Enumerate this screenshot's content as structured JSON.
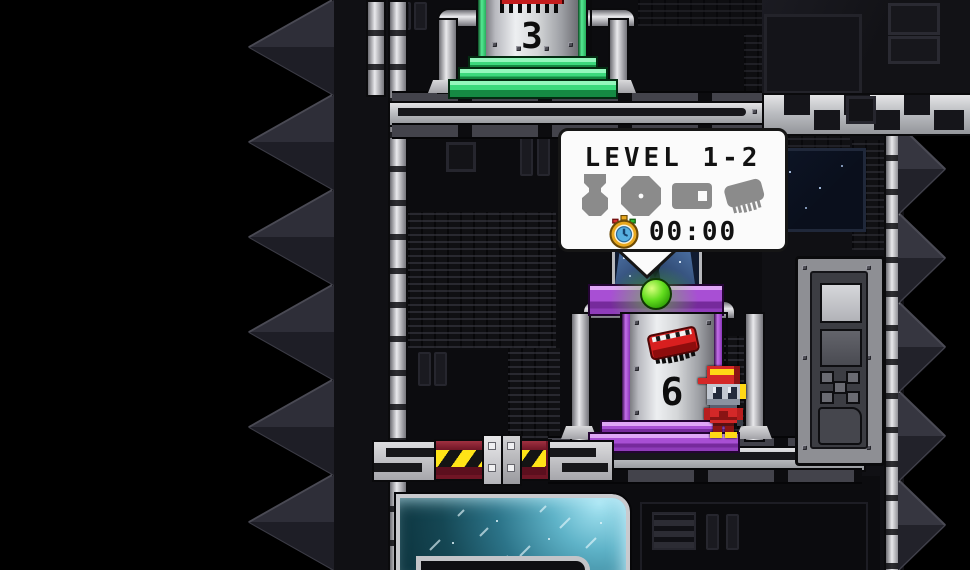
{
  "popup": {
    "title": "LEVEL 1-2",
    "collectible_icons": [
      {
        "name": "medal-silhouette"
      },
      {
        "name": "gear-silhouette"
      },
      {
        "name": "canister-silhouette"
      },
      {
        "name": "chip-silhouette"
      }
    ],
    "timer": {
      "icon": "stopwatch-icon",
      "value": "00:00"
    }
  },
  "level_towers": [
    {
      "id": "tower-3",
      "number": "3",
      "accent_color": "#42e084",
      "icon": "chip-icon"
    },
    {
      "id": "tower-6",
      "number": "6",
      "accent_color": "#9a3fd0",
      "icon": "chip-icon"
    }
  ],
  "player": {
    "name": "robot-player"
  },
  "colors": {
    "popup_bg": "#fbfbfb",
    "popup_text": "#121212",
    "silhouette_gray": "#8b8b8b",
    "green_accent": "#42e084",
    "purple_accent": "#9a3fd0",
    "teal_glass": "#3f93a8",
    "hazard_yellow": "#ffe317",
    "hazard_maroon": "#701525"
  }
}
